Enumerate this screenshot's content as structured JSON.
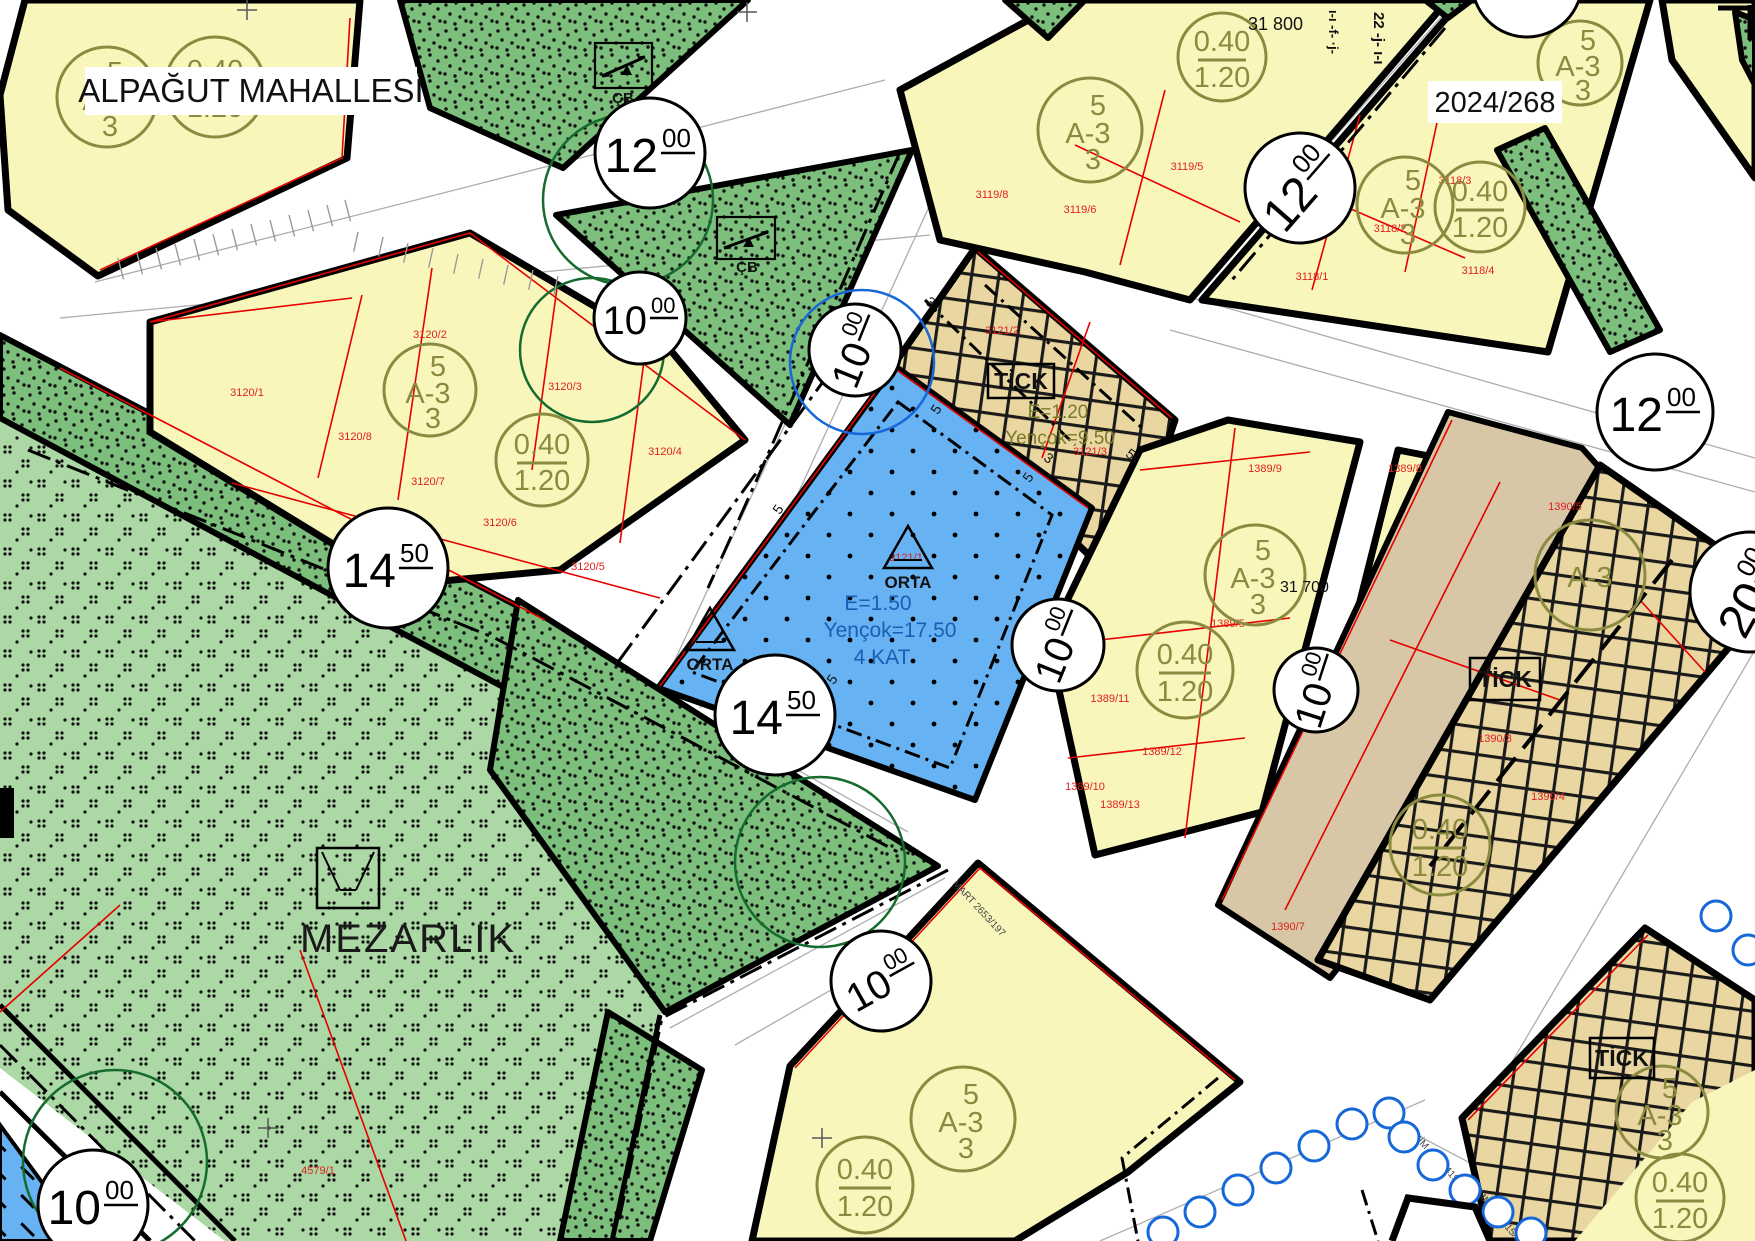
{
  "labels": {
    "neighborhood": "ALPAĞUT MAHALLESİ",
    "plan_no": "2024/268",
    "cemetery": "MEZARLIK",
    "grid_north": "31 800",
    "grid_south": "31 700",
    "pafta_col1": "ı-ı -f- ·j-",
    "pafta_col2": "22 -j- ı-ı"
  },
  "zone_notations": {
    "a3_stack": {
      "top": "5",
      "mid": "A-3",
      "bottom": "3"
    },
    "density": {
      "top": "0.40",
      "bottom": "1.20"
    },
    "a3_single": "A-3"
  },
  "blue_zone": {
    "name": "ORTA",
    "e": "E=1.50",
    "hmax": "Yençok=17.50",
    "floors": "4 KAT"
  },
  "tick_zone": {
    "name": "TİCK",
    "e": "E=1.20",
    "hmax": "Yençok=9.50"
  },
  "park": {
    "cb": "ÇB"
  },
  "setbacks": {
    "five": "5",
    "three": "3"
  },
  "road_circles": [
    {
      "main": "12",
      "sup": "00"
    },
    {
      "main": "10",
      "sup": "00"
    },
    {
      "main": "10",
      "sup": "00"
    },
    {
      "main": "12",
      "sup": "00"
    },
    {
      "main": "12",
      "sup": "00"
    },
    {
      "main": "14",
      "sup": "50"
    },
    {
      "main": "14",
      "sup": "50"
    },
    {
      "main": "10",
      "sup": "00"
    },
    {
      "main": "10",
      "sup": "00"
    },
    {
      "main": "10",
      "sup": "00"
    },
    {
      "main": "10",
      "sup": "00"
    },
    {
      "main": "20",
      "sup": "00"
    }
  ],
  "parcels": [
    "3120/1",
    "3120/2",
    "3120/3",
    "3120/4",
    "3120/5",
    "3120/6",
    "3120/7",
    "3120/8",
    "3119/5",
    "3119/6",
    "3119/8",
    "3118/1",
    "3118/2",
    "3118/3",
    "3118/4",
    "3121/1",
    "3121/2",
    "3121/3",
    "1389/5",
    "1389/8",
    "1389/9",
    "1389/10",
    "1389/11",
    "1389/12",
    "1389/13",
    "1390/3",
    "1390/4",
    "1390/5",
    "1390/7",
    "4579/1"
  ],
  "plan_refs": [
    "MART 2653/197",
    "EKİM 2018/419",
    "TEMMUZ 2015/282"
  ]
}
